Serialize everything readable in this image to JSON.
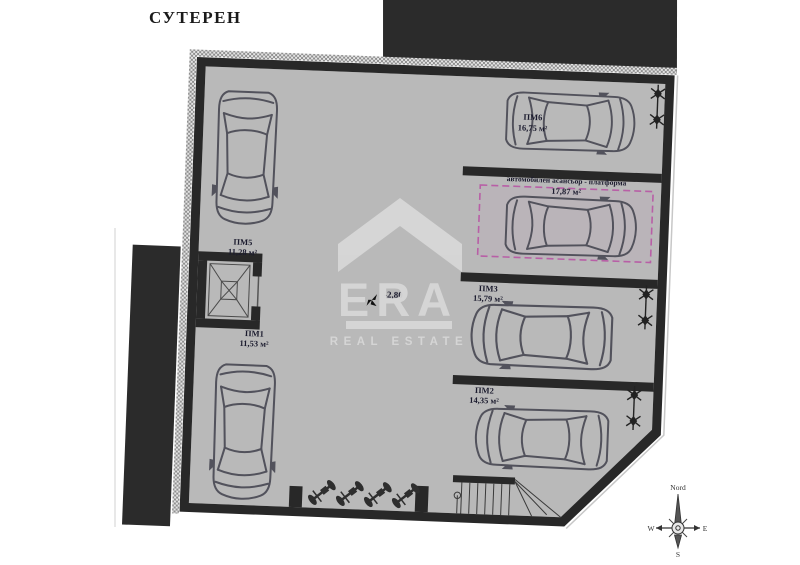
{
  "title": "СУТЕРЕН",
  "plan": {
    "level_marker": "-2,80",
    "spaces": [
      {
        "id": "ПМ5",
        "area": "11,28 м²"
      },
      {
        "id": "ПМ1",
        "area": "11,53 м²"
      },
      {
        "id": "ПМ6",
        "area": "16,75 м²"
      },
      {
        "id": "ПМ3",
        "area": "15,79 м²"
      },
      {
        "id": "ПМ2",
        "area": "14,35 м²"
      }
    ],
    "car_lift": {
      "name": "автомобилен асансьор - платформа",
      "area": "17,87 м²"
    }
  },
  "watermark": {
    "brand": "ERA",
    "tagline": "REAL ESTATE"
  },
  "compass": {
    "north": "Nord",
    "west": "W",
    "east": "E",
    "south": "S"
  },
  "colors": {
    "floor": "#b9b9b9",
    "wall": "#282828",
    "lift_accent": "#b85fa6",
    "watermark": "#d7d7d7",
    "label": "#1b1b2e"
  }
}
